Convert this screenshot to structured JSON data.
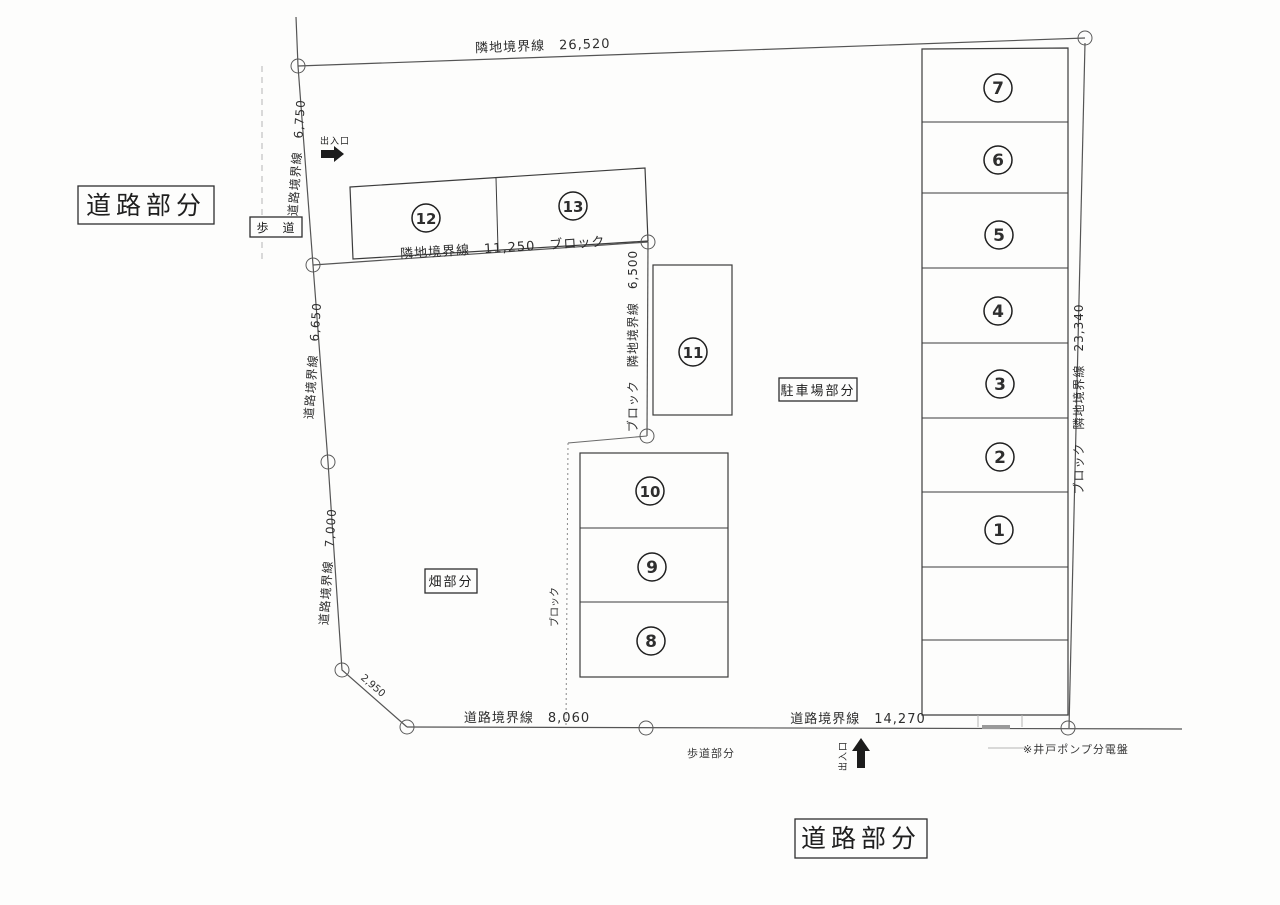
{
  "drawing": {
    "type": "parking-lot-site-plan",
    "paper_color": "#fdfdfc",
    "line_color": "#555555"
  },
  "labels": {
    "road_area_top": "道路部分",
    "road_area_bottom": "道路部分",
    "sidewalk": "歩　道",
    "sidewalk_area": "歩道部分",
    "parking_area": "駐車場部分",
    "field_area": "畑部分",
    "entrance_top": "出入口",
    "entrance_bottom": "出入口",
    "well_pump_note": "※井戸ポンプ分電盤"
  },
  "dimensions": {
    "top_boundary": "隣地境界線　26,520",
    "left_upper": "道路境界線　6,750",
    "left_middle": "道路境界線　6,650",
    "left_lower": "道路境界線　7,000",
    "left_diagonal": "2,950",
    "bottom_left": "道路境界線　8,060",
    "bottom_right": "道路境界線　14,270",
    "right_boundary": "ブロック　隣地境界線　23,340",
    "inner_upper": "隣地境界線　11,250　ブロック",
    "inner_vertical": "ブロック　隣地境界線　6,500",
    "block_wall": "ブロック"
  },
  "stalls": {
    "n1": "1",
    "n2": "2",
    "n3": "3",
    "n4": "4",
    "n5": "5",
    "n6": "6",
    "n7": "7",
    "n8": "8",
    "n9": "9",
    "n10": "10",
    "n11": "11",
    "n12": "12",
    "n13": "13"
  }
}
